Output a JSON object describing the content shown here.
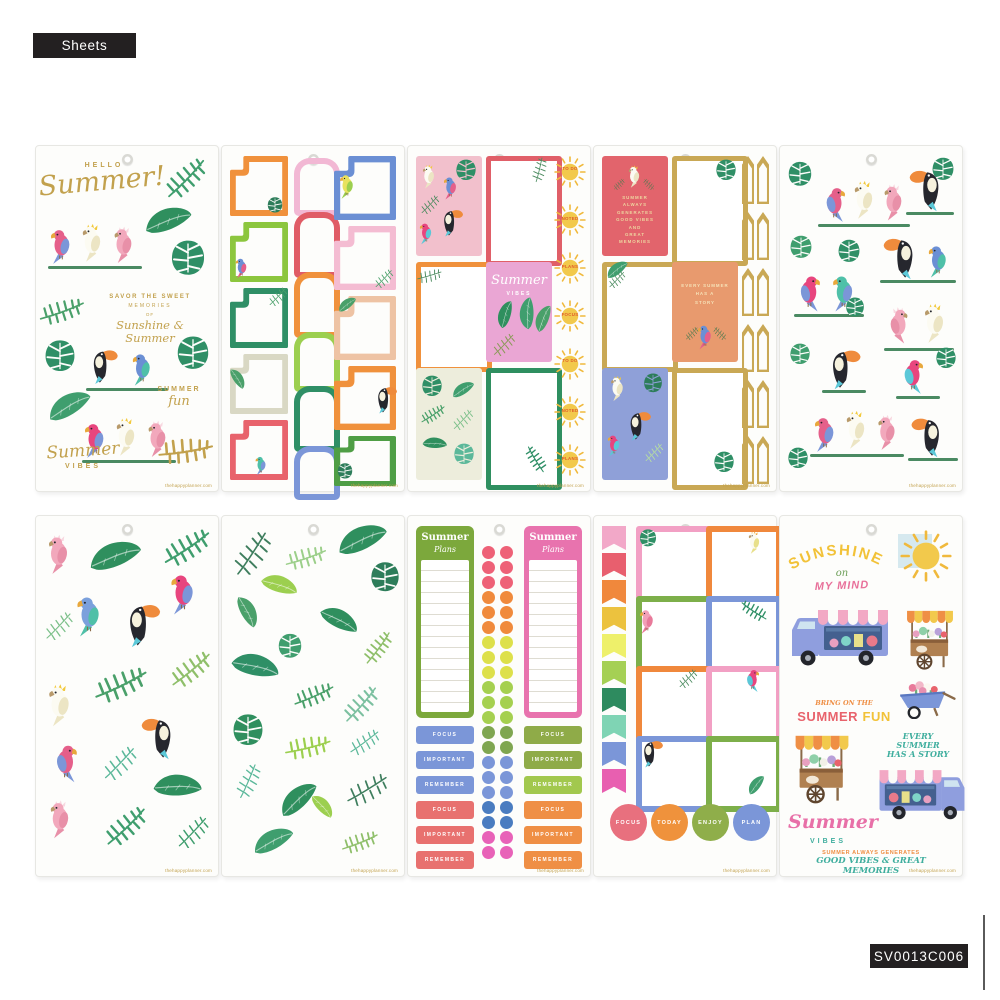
{
  "page": {
    "top_badge": "Sheets",
    "sku_badge": "SV0013C006",
    "watermark": "thehappyplanner.com"
  },
  "palette": {
    "gold": "#c2a14d",
    "coral": "#e8636c",
    "red": "#e05c66",
    "orange": "#f0913c",
    "peach": "#e89a6e",
    "pink": "#f2a8c8",
    "hot_pink": "#e870a8",
    "lime": "#9ccf4f",
    "green": "#2f8f66",
    "leaf_green": "#3f9e6e",
    "periwinkle": "#7b96d8",
    "blue": "#4a7cc0",
    "teal": "#3fae9e",
    "yellow": "#f2c94c",
    "cream": "#ededdc",
    "badge_black": "#232021"
  },
  "sheet_hello_summer": {
    "hello": "HELLO",
    "title": "Summer!",
    "savor_1": "SAVOR THE SWEET",
    "savor_2": "MEMORIES",
    "savor_3": "OF",
    "savor_4": "Sunshine & Summer",
    "fun_1": "SUMMER",
    "fun_2": "fun",
    "vibes_1": "Summer",
    "vibes_2": "VIBES"
  },
  "sheet_tropical_panels": {
    "suns": [
      "TO DO",
      "NOTED",
      "PLANS",
      "FOCUS",
      "TO DO",
      "NOTED",
      "PLANS"
    ],
    "vibes_1": "Summer",
    "vibes_2": "VIBES"
  },
  "sheet_gold_panels": {
    "coral_lines": [
      "SUMMER",
      "ALWAYS",
      "GENERATES",
      "GOOD VIBES",
      "AND",
      "GREAT",
      "MEMORIES"
    ],
    "peach_lines": [
      "EVERY SUMMER",
      "HAS A",
      "STORY"
    ]
  },
  "sheet_summer_plans": {
    "header_1": "Summer",
    "header_2": "Plans",
    "labels": [
      "FOCUS",
      "IMPORTANT",
      "REMEMBER",
      "FOCUS",
      "IMPORTANT",
      "REMEMBER"
    ]
  },
  "sheet_note_boxes": {
    "circles": [
      "FOCUS",
      "TODAY",
      "ENJOY",
      "PLAN"
    ]
  },
  "sheet_sunshine": {
    "sunshine": "SUNSHINE",
    "on": "on",
    "my_mind": "MY MIND",
    "bring": "BRING ON THE",
    "summer": "SUMMER",
    "fun": "FUN",
    "story_1": "EVERY SUMMER",
    "story_2": "HAS A STORY",
    "vibes_1": "Summer",
    "vibes_2": "VIBES",
    "generates": "SUMMER ALWAYS GENERATES",
    "memories": "GOOD VIBES & GREAT MEMORIES"
  }
}
